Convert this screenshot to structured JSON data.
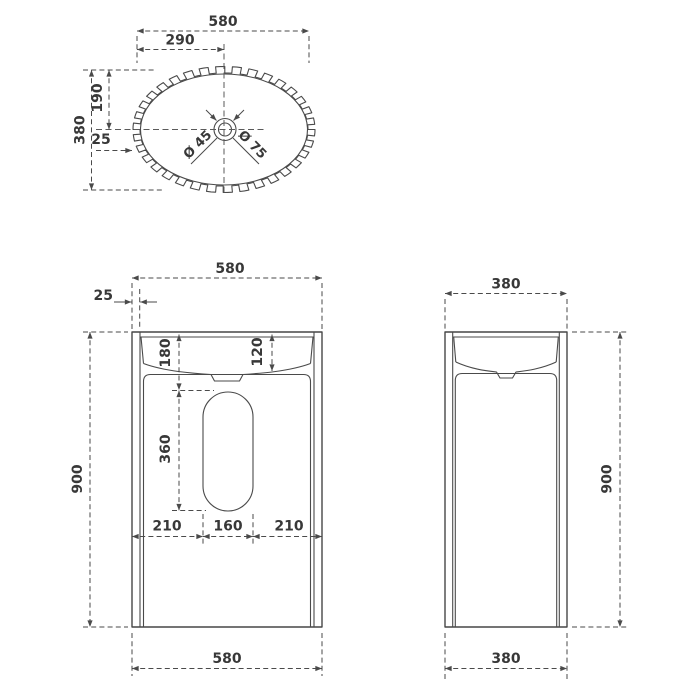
{
  "top_view": {
    "overall_width": "580",
    "center_width": "290",
    "overall_depth": "380",
    "center_depth": "190",
    "edge_offset": "25",
    "drain_small": "Ø 45",
    "drain_large": "Ø 75"
  },
  "front_view": {
    "overall_width": "580",
    "wall_thickness": "25",
    "depth_to_cutout": "180",
    "basin_depth": "120",
    "cutout_height": "360",
    "left_offset": "210",
    "cutout_width": "160",
    "right_offset": "210",
    "overall_height": "900",
    "base_width": "580"
  },
  "side_view": {
    "overall_width": "380",
    "overall_height": "900",
    "base_width": "380"
  }
}
